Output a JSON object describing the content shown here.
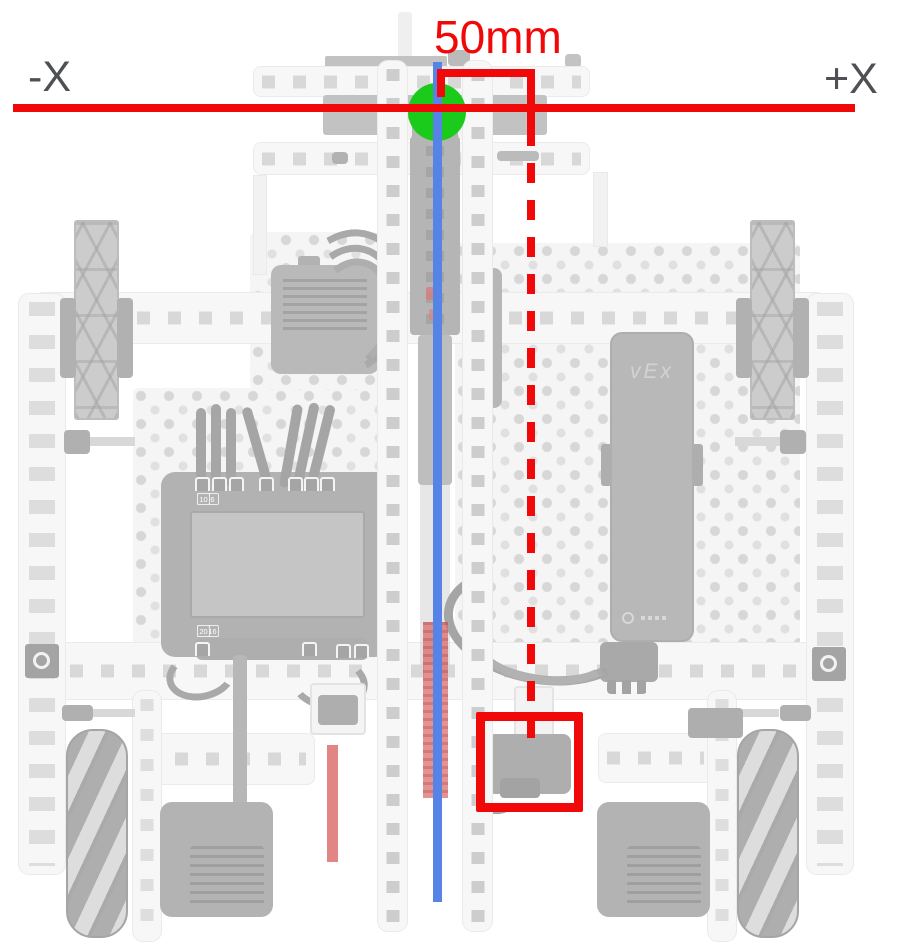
{
  "annotations": {
    "measurement_label": "50mm",
    "axis_negative_label": "-X",
    "axis_positive_label": "+X",
    "colors": {
      "annotation_red": "#f10808",
      "origin_green": "#1bcb1b",
      "centerline_blue": "#5584e6",
      "offset_pink": "#d96a6a",
      "axis_label_gray": "#4f5054"
    }
  },
  "robot": {
    "battery_logo": "vEx",
    "brain": {
      "ports_top": [
        "1",
        "2",
        "3",
        "4",
        "5",
        "6",
        "7",
        "8",
        "9",
        "10"
      ],
      "ports_bottom": [
        "11",
        "12",
        "13",
        "14",
        "15",
        "16",
        "17",
        "18",
        "19",
        "20"
      ]
    }
  }
}
